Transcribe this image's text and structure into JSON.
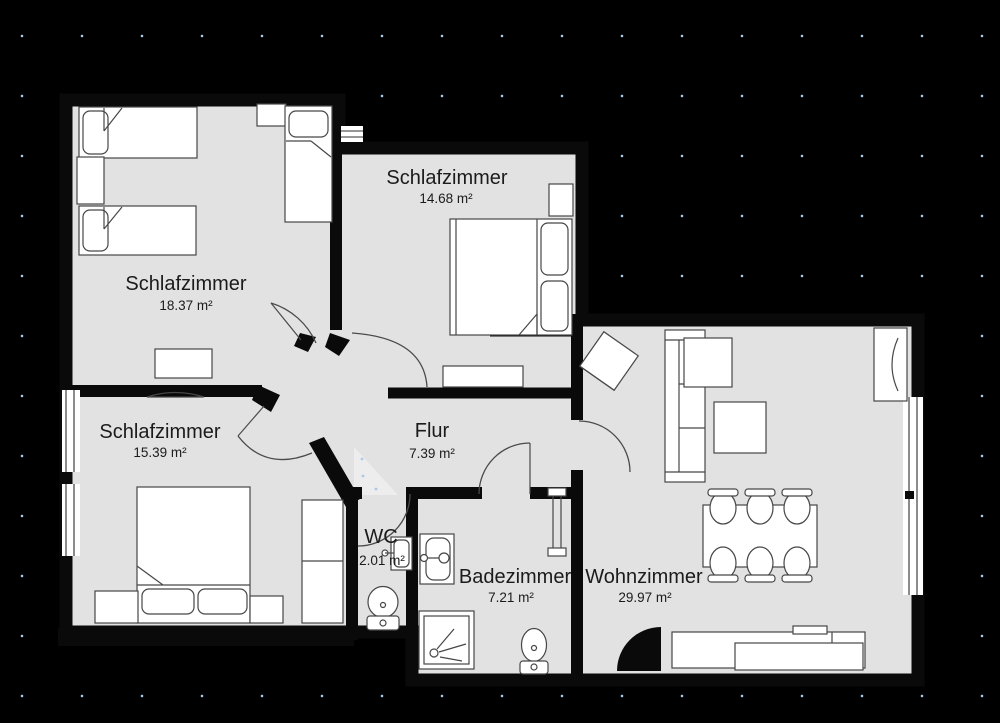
{
  "plan": {
    "kind": "apartment-floorplan",
    "unit_suffix": "m²"
  },
  "rooms": [
    {
      "id": "bedroom-1",
      "name": "Schlafzimmer",
      "area": "18.37 m²"
    },
    {
      "id": "bedroom-2",
      "name": "Schlafzimmer",
      "area": "14.68 m²"
    },
    {
      "id": "bedroom-3",
      "name": "Schlafzimmer",
      "area": "15.39 m²"
    },
    {
      "id": "hallway",
      "name": "Flur",
      "area": "7.39 m²"
    },
    {
      "id": "wc",
      "name": "WC",
      "area": "2.01 m²"
    },
    {
      "id": "bathroom",
      "name": "Badezimmer",
      "area": "7.21 m²"
    },
    {
      "id": "living-room",
      "name": "Wohnzimmer",
      "area": "29.97 m²"
    }
  ],
  "colors": {
    "background": "#000000",
    "floor": "#e2e2e2",
    "floor_highlight": "#ededed",
    "wall": "#0a0a0a",
    "furniture_fill": "#ffffff",
    "furniture_stroke": "#474747",
    "label_text": "#1b1b1b",
    "grid_dot": "#a9c9e9"
  }
}
